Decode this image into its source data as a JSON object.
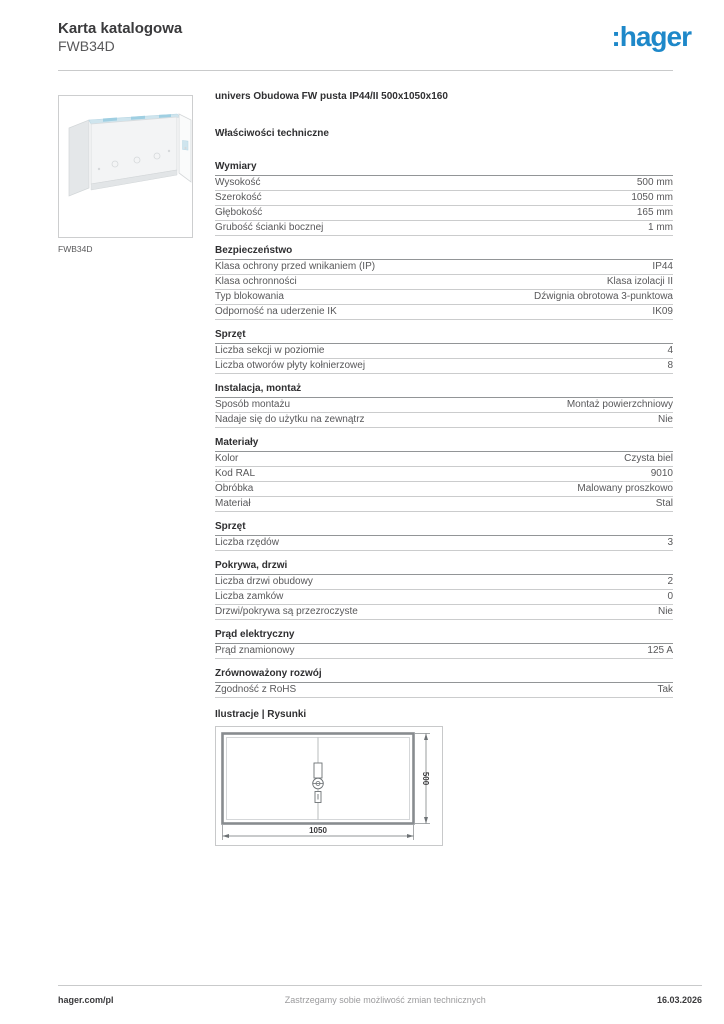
{
  "header": {
    "doc_type": "Karta katalogowa",
    "product_code": "FWB34D",
    "brand": ":hager",
    "brand_color": "#1e88c9"
  },
  "product": {
    "image_caption": "FWB34D",
    "title": "univers Obudowa FW pusta IP44/II 500x1050x160"
  },
  "tech": {
    "heading": "Właściwości techniczne",
    "sections": [
      {
        "title": "Wymiary",
        "rows": [
          {
            "label": "Wysokość",
            "value": "500 mm"
          },
          {
            "label": "Szerokość",
            "value": "1050 mm"
          },
          {
            "label": "Głębokość",
            "value": "165 mm"
          },
          {
            "label": "Grubość ścianki bocznej",
            "value": "1 mm"
          }
        ]
      },
      {
        "title": "Bezpieczeństwo",
        "rows": [
          {
            "label": "Klasa ochrony przed wnikaniem (IP)",
            "value": "IP44"
          },
          {
            "label": "Klasa ochronności",
            "value": "Klasa izolacji II"
          },
          {
            "label": "Typ blokowania",
            "value": "Dźwignia obrotowa 3-punktowa"
          },
          {
            "label": "Odporność na uderzenie IK",
            "value": "IK09"
          }
        ]
      },
      {
        "title": "Sprzęt",
        "rows": [
          {
            "label": "Liczba sekcji w poziomie",
            "value": "4"
          },
          {
            "label": "Liczba otworów płyty kołnierzowej",
            "value": "8"
          }
        ]
      },
      {
        "title": "Instalacja, montaż",
        "rows": [
          {
            "label": "Sposób montażu",
            "value": "Montaż powierzchniowy"
          },
          {
            "label": "Nadaje się do użytku na zewnątrz",
            "value": "Nie"
          }
        ]
      },
      {
        "title": "Materiały",
        "rows": [
          {
            "label": "Kolor",
            "value": "Czysta biel"
          },
          {
            "label": "Kod RAL",
            "value": "9010"
          },
          {
            "label": "Obróbka",
            "value": "Malowany proszkowo"
          },
          {
            "label": "Materiał",
            "value": "Stal"
          }
        ]
      },
      {
        "title": "Sprzęt",
        "rows": [
          {
            "label": "Liczba rzędów",
            "value": "3"
          }
        ]
      },
      {
        "title": "Pokrywa, drzwi",
        "rows": [
          {
            "label": "Liczba drzwi obudowy",
            "value": "2"
          },
          {
            "label": "Liczba zamków",
            "value": "0"
          },
          {
            "label": "Drzwi/pokrywa są przezroczyste",
            "value": "Nie"
          }
        ]
      },
      {
        "title": "Prąd elektryczny",
        "rows": [
          {
            "label": "Prąd znamionowy",
            "value": "125 A"
          }
        ]
      },
      {
        "title": "Zrównoważony rozwój",
        "rows": [
          {
            "label": "Zgodność z RoHS",
            "value": "Tak"
          }
        ]
      }
    ]
  },
  "illustrations": {
    "heading": "Ilustracje | Rysunki",
    "width_label": "1050",
    "height_label": "500"
  },
  "footer": {
    "website": "hager.com/pl",
    "disclaimer": "Zastrzegamy sobie możliwość zmian technicznych",
    "date": "16.03.2026"
  }
}
